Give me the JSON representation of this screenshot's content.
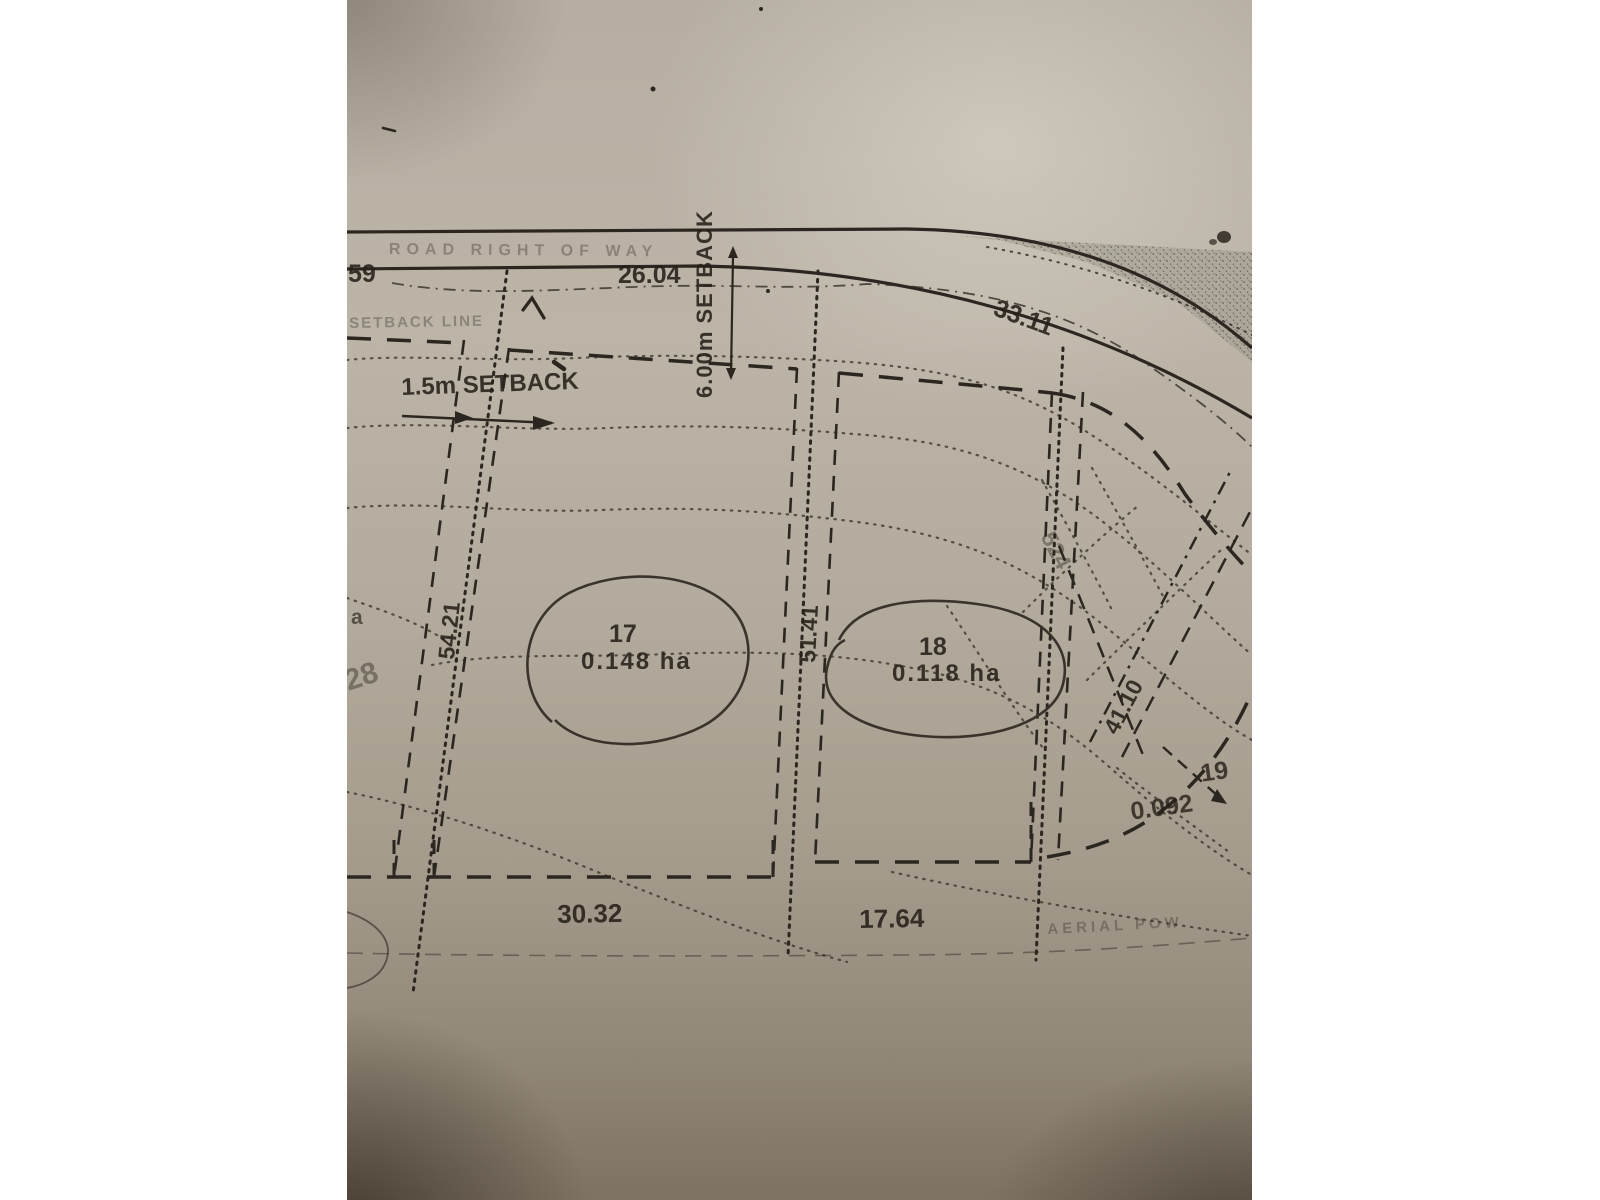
{
  "plan": {
    "road_label": "ROAD RIGHT OF WAY",
    "setback_line_label": "SETBACK LINE",
    "front_setback_label": "6.00m  SETBACK",
    "side_setback_label": "1.5m SETBACK",
    "lots": [
      {
        "number": "17",
        "area": "0.148 ha"
      },
      {
        "number": "18",
        "area": "0.118 ha"
      },
      {
        "number": "19",
        "area": "0.092"
      }
    ],
    "dimensions": {
      "edge_partial": "59",
      "lot17_frontage": "26.04",
      "lot18_frontage": "33.11",
      "lot17_left_side": "54.21",
      "lot17_18_side": "51.41",
      "lot19_side": "41.10",
      "lot17_rear": "30.32",
      "lot18_rear": "17.64"
    },
    "contour_labels": {
      "c524": "524",
      "c28": "28",
      "partial_a": "a"
    },
    "faint_note": "AERIAL POW"
  },
  "colors": {
    "ink": "#2b2620",
    "paper": "#b6aea2"
  }
}
